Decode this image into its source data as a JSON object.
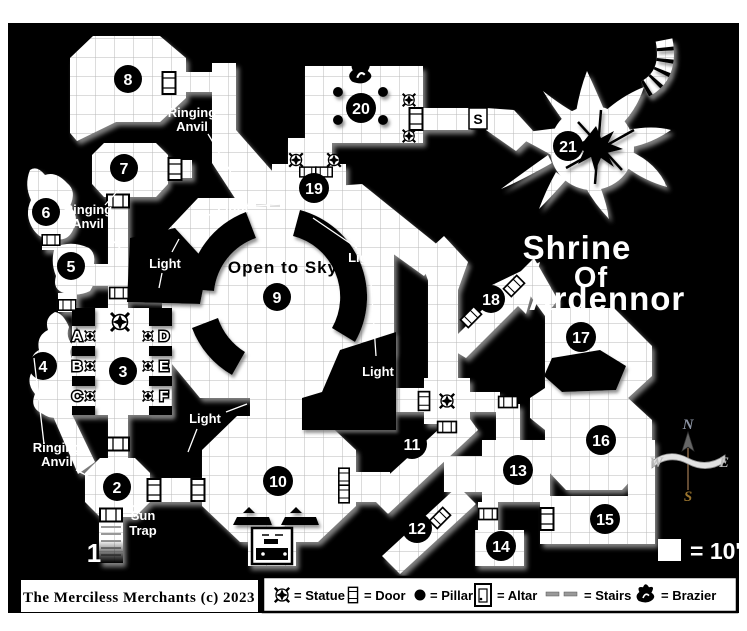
{
  "map": {
    "title_lines": [
      "Shrine",
      "Of",
      "Ardennor"
    ],
    "room_numbers": [
      "1",
      "2",
      "3",
      "4",
      "5",
      "6",
      "7",
      "8",
      "9",
      "10",
      "11",
      "12",
      "13",
      "14",
      "15",
      "16",
      "17",
      "18",
      "19",
      "20",
      "21"
    ],
    "alcove_letters": [
      "A",
      "B",
      "C",
      "D",
      "E",
      "F"
    ],
    "labels": {
      "ringing": "Ringing",
      "anvil": "Anvil",
      "light": "Light",
      "open_to_sky": "Open to Sky",
      "sun": "Sun",
      "trap": "Trap",
      "stairs_marker": "S"
    },
    "compass": {
      "n": "N",
      "e": "E",
      "s": "S",
      "w": "W"
    },
    "scale_label": "= 10'"
  },
  "legend": {
    "items": [
      {
        "icon": "statue-icon",
        "label": "= Statue"
      },
      {
        "icon": "door-icon",
        "label": "= Door"
      },
      {
        "icon": "pillar-icon",
        "label": "= Pillar"
      },
      {
        "icon": "altar-icon",
        "label": "= Altar"
      },
      {
        "icon": "stairs-icon",
        "label": "= Stairs"
      },
      {
        "icon": "brazier-icon",
        "label": "= Brazier"
      }
    ]
  },
  "footer": {
    "copyright": "The Merciless Merchants (c) 2023"
  },
  "colors": {
    "background": "#000000",
    "room_fill": "#ffffff",
    "grid_line": "#b9b9b9",
    "shadow": "#8f8f8f",
    "compass_gold": "#99742e"
  }
}
